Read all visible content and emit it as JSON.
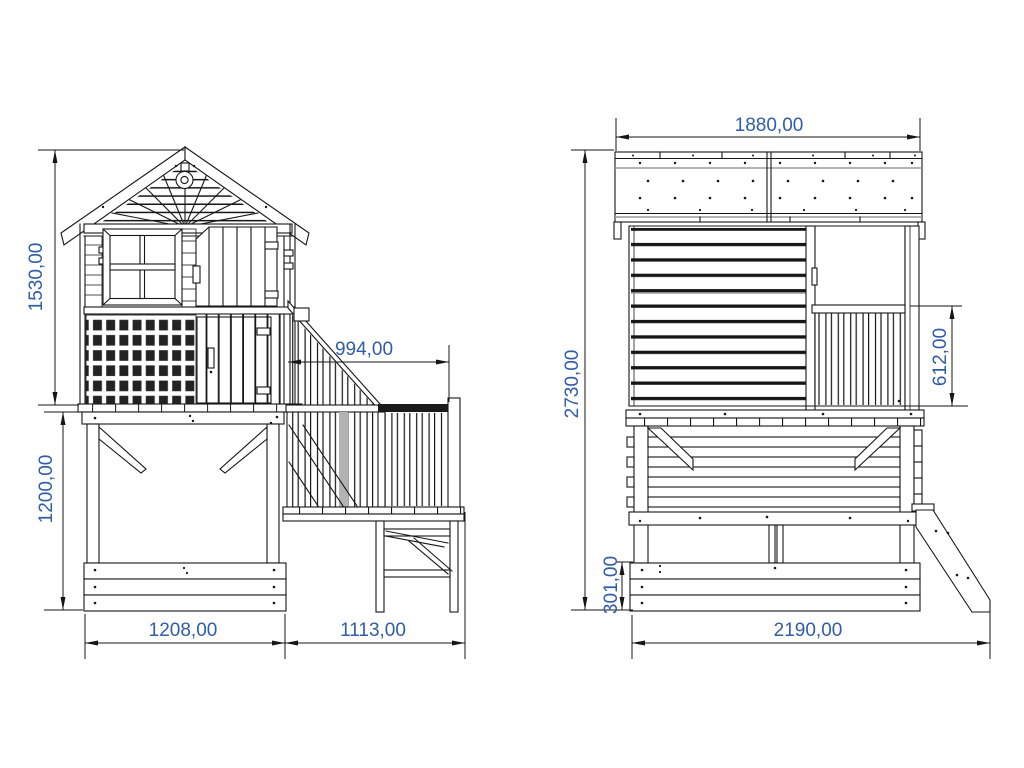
{
  "drawing": {
    "type": "technical-elevation-drawing",
    "subject": "wooden playhouse with platform, stairs and slide",
    "background_color": "#ffffff",
    "line_color": "#161616",
    "dimension_text_color": "#305da8",
    "views": {
      "side_view": {
        "dims": {
          "house_height": "1530,00",
          "base_height": "1200,00",
          "stair_run": "994,00",
          "house_width": "1208,00",
          "stair_width": "1113,00"
        }
      },
      "rear_view": {
        "dims": {
          "roof_width": "1880,00",
          "total_height": "2730,00",
          "railing_height": "612,00",
          "sandbox_height": "301,00",
          "total_width": "2190,00"
        }
      }
    }
  }
}
